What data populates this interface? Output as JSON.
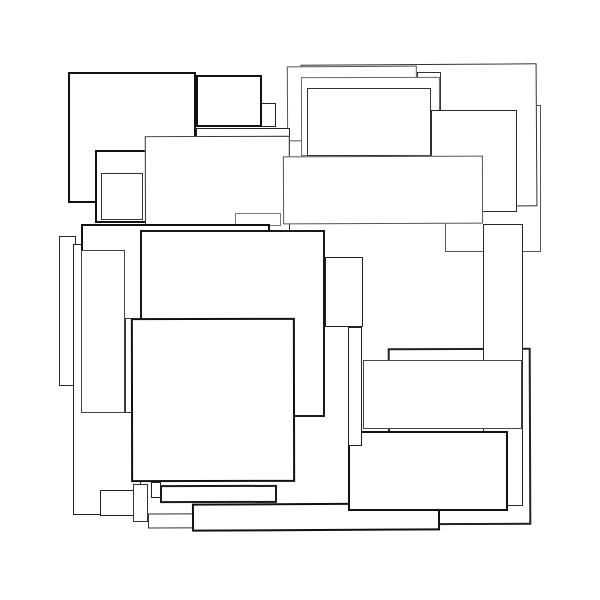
{
  "artwork": {
    "title": "overlapping-squares-abstract-vector",
    "background": "#ffffff",
    "canvas_width": 600,
    "canvas_height": 600,
    "stroke_palette": [
      "#111111",
      "#1a1a1a",
      "#222222",
      "#2a2a2a",
      "#333333",
      "#444444",
      "#555555",
      "#666666",
      "#777777"
    ],
    "fill_color": "#ffffff",
    "rects": [
      {
        "name": "right-tall-back-square",
        "x": 445,
        "y": 105,
        "w": 96,
        "h": 147,
        "stroke": "#555555",
        "weight": 1.5,
        "rot": 0
      },
      {
        "name": "bottom-right-back-square",
        "x": 388,
        "y": 348,
        "w": 143,
        "h": 177,
        "stroke": "#222222",
        "weight": 2,
        "rot": -0.2
      },
      {
        "name": "right-narrow-tall-square",
        "x": 483,
        "y": 224,
        "w": 40,
        "h": 282,
        "stroke": "#2a2a2a",
        "weight": 1.5,
        "rot": 0
      },
      {
        "name": "top-right-large-square",
        "x": 301,
        "y": 64,
        "w": 236,
        "h": 143,
        "stroke": "#333333",
        "weight": 1.5,
        "rot": -0.35
      },
      {
        "name": "top-right-step-square",
        "x": 417,
        "y": 72,
        "w": 24,
        "h": 38,
        "stroke": "#333333",
        "weight": 1.5,
        "rot": 0
      },
      {
        "name": "top-center-wide-square",
        "x": 287,
        "y": 66,
        "w": 130,
        "h": 75,
        "stroke": "#555555",
        "weight": 1.5,
        "rot": -0.3
      },
      {
        "name": "top-center-overlay-square",
        "x": 301,
        "y": 77,
        "w": 139,
        "h": 79,
        "stroke": "#666666",
        "weight": 1.5,
        "rot": -0.15
      },
      {
        "name": "top-center-inner-square",
        "x": 307,
        "y": 88,
        "w": 124,
        "h": 68,
        "stroke": "#333333",
        "weight": 1.5,
        "rot": 0
      },
      {
        "name": "top-right-mid-square",
        "x": 431,
        "y": 110,
        "w": 86,
        "h": 102,
        "stroke": "#2a2a2a",
        "weight": 1.5,
        "rot": 0
      },
      {
        "name": "small-sliver-square",
        "x": 261,
        "y": 103,
        "w": 15,
        "h": 24,
        "stroke": "#222222",
        "weight": 1.5,
        "rot": 0
      },
      {
        "name": "top-small-bold-square",
        "x": 196,
        "y": 75,
        "w": 66,
        "h": 52,
        "stroke": "#111111",
        "weight": 2,
        "rot": 0
      },
      {
        "name": "top-thin-band",
        "x": 196,
        "y": 128,
        "w": 94,
        "h": 30,
        "stroke": "#222222",
        "weight": 1.5,
        "rot": 0
      },
      {
        "name": "top-left-bold-square",
        "x": 68,
        "y": 72,
        "w": 128,
        "h": 131,
        "stroke": "#111111",
        "weight": 2.5,
        "rot": 0
      },
      {
        "name": "left-mid-bold-square",
        "x": 95,
        "y": 150,
        "w": 53,
        "h": 73,
        "stroke": "#111111",
        "weight": 2,
        "rot": 0
      },
      {
        "name": "left-mid-inner-square",
        "x": 101,
        "y": 173,
        "w": 42,
        "h": 47,
        "stroke": "#333333",
        "weight": 1.5,
        "rot": 0
      },
      {
        "name": "center-left-large-square",
        "x": 145,
        "y": 136,
        "w": 145,
        "h": 182,
        "stroke": "#333333",
        "weight": 1.5,
        "rot": -0.15
      },
      {
        "name": "center-wide-rect",
        "x": 283,
        "y": 156,
        "w": 200,
        "h": 68,
        "stroke": "#555555",
        "weight": 1.5,
        "rot": -0.2
      },
      {
        "name": "center-thin-sliver",
        "x": 235,
        "y": 213,
        "w": 46,
        "h": 13,
        "stroke": "#777777",
        "weight": 1.5,
        "rot": 0
      },
      {
        "name": "left-tall-narrow-square",
        "x": 59,
        "y": 236,
        "w": 17,
        "h": 150,
        "stroke": "#2a2a2a",
        "weight": 1.5,
        "rot": 0
      },
      {
        "name": "left-tall-square",
        "x": 73,
        "y": 244,
        "w": 68,
        "h": 271,
        "stroke": "#222222",
        "weight": 1.5,
        "rot": 0
      },
      {
        "name": "mid-left-bold-square",
        "x": 81,
        "y": 224,
        "w": 189,
        "h": 189,
        "stroke": "#111111",
        "weight": 2,
        "rot": 0
      },
      {
        "name": "mid-left-gap-sliver",
        "x": 125,
        "y": 318,
        "w": 10,
        "h": 95,
        "stroke": "#333333",
        "weight": 1.5,
        "rot": 0
      },
      {
        "name": "left-inner-tall-square",
        "x": 81,
        "y": 250,
        "w": 44,
        "h": 163,
        "stroke": "#444444",
        "weight": 1.5,
        "rot": 0
      },
      {
        "name": "center-large-square",
        "x": 140,
        "y": 230,
        "w": 185,
        "h": 187,
        "stroke": "#1a1a1a",
        "weight": 2,
        "rot": 0
      },
      {
        "name": "center-right-step-square",
        "x": 325,
        "y": 257,
        "w": 38,
        "h": 70,
        "stroke": "#222222",
        "weight": 1.5,
        "rot": 0
      },
      {
        "name": "right-mid-wide-rect",
        "x": 363,
        "y": 360,
        "w": 159,
        "h": 69,
        "stroke": "#444444",
        "weight": 1.5,
        "rot": 0
      },
      {
        "name": "bottom-under-band",
        "x": 148,
        "y": 513,
        "w": 287,
        "h": 15,
        "stroke": "#333333",
        "weight": 1.5,
        "rot": -0.2
      },
      {
        "name": "bottom-wide-band",
        "x": 192,
        "y": 503,
        "w": 248,
        "h": 28,
        "stroke": "#111111",
        "weight": 2,
        "rot": -0.3
      },
      {
        "name": "bottom-right-bold-rect",
        "x": 348,
        "y": 431,
        "w": 160,
        "h": 80,
        "stroke": "#111111",
        "weight": 2,
        "rot": 0
      },
      {
        "name": "center-narrow-tall-sliver",
        "x": 348,
        "y": 327,
        "w": 14,
        "h": 119,
        "stroke": "#222222",
        "weight": 1.5,
        "rot": 0
      },
      {
        "name": "bottom-center-bold-square",
        "x": 131,
        "y": 318,
        "w": 164,
        "h": 164,
        "stroke": "#111111",
        "weight": 2,
        "rot": -0.1
      },
      {
        "name": "bottom-left-step-rect",
        "x": 100,
        "y": 490,
        "w": 43,
        "h": 26,
        "stroke": "#222222",
        "weight": 1.5,
        "rot": 0
      },
      {
        "name": "bottom-left-small-sliver",
        "x": 133,
        "y": 484,
        "w": 15,
        "h": 38,
        "stroke": "#333333",
        "weight": 1.5,
        "rot": 0
      },
      {
        "name": "bottom-tiny-sliver",
        "x": 151,
        "y": 482,
        "w": 10,
        "h": 16,
        "stroke": "#222222",
        "weight": 1.5,
        "rot": 0
      },
      {
        "name": "bottom-center-band",
        "x": 160,
        "y": 485,
        "w": 117,
        "h": 18,
        "stroke": "#1a1a1a",
        "weight": 2,
        "rot": -0.1
      }
    ]
  }
}
